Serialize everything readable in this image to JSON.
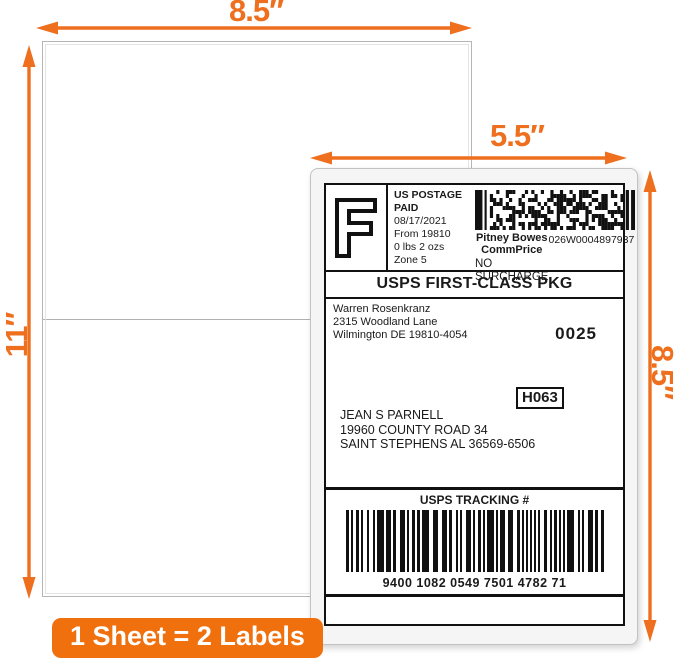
{
  "dimensions": {
    "sheet_width": "8.5″",
    "sheet_height": "11″",
    "label_width": "5.5″",
    "label_height": "8.5″"
  },
  "badge": {
    "text": "1 Sheet = 2 Labels"
  },
  "label": {
    "fim_letter": "F",
    "postage": {
      "line1": "US POSTAGE",
      "line2": "PAID",
      "date": "08/17/2021",
      "origin": "From 19810",
      "weight": "0 lbs 2 ozs",
      "zone": "Zone 5"
    },
    "meter": {
      "provider_line1": "Pitney Bowes",
      "provider_line2": "CommPrice",
      "serial": "026W0004897937",
      "surcharge": "NO SURCHARGE"
    },
    "service": "USPS FIRST-CLASS PKG",
    "sender": {
      "name": "Warren Rosenkranz",
      "street": "2315 Woodland Lane",
      "city": "Wilmington DE 19810-4054"
    },
    "batch": "0025",
    "sort_code": "H063",
    "recipient": {
      "name": "JEAN S PARNELL",
      "street": "19960 COUNTY ROAD 34",
      "city": "SAINT STEPHENS AL 36569-6506"
    },
    "tracking": {
      "title": "USPS TRACKING #",
      "number": "9400 1082 0549 7501 4782 71"
    }
  },
  "colors": {
    "accent": "#EE6F1E",
    "badge": "#F0700E"
  }
}
